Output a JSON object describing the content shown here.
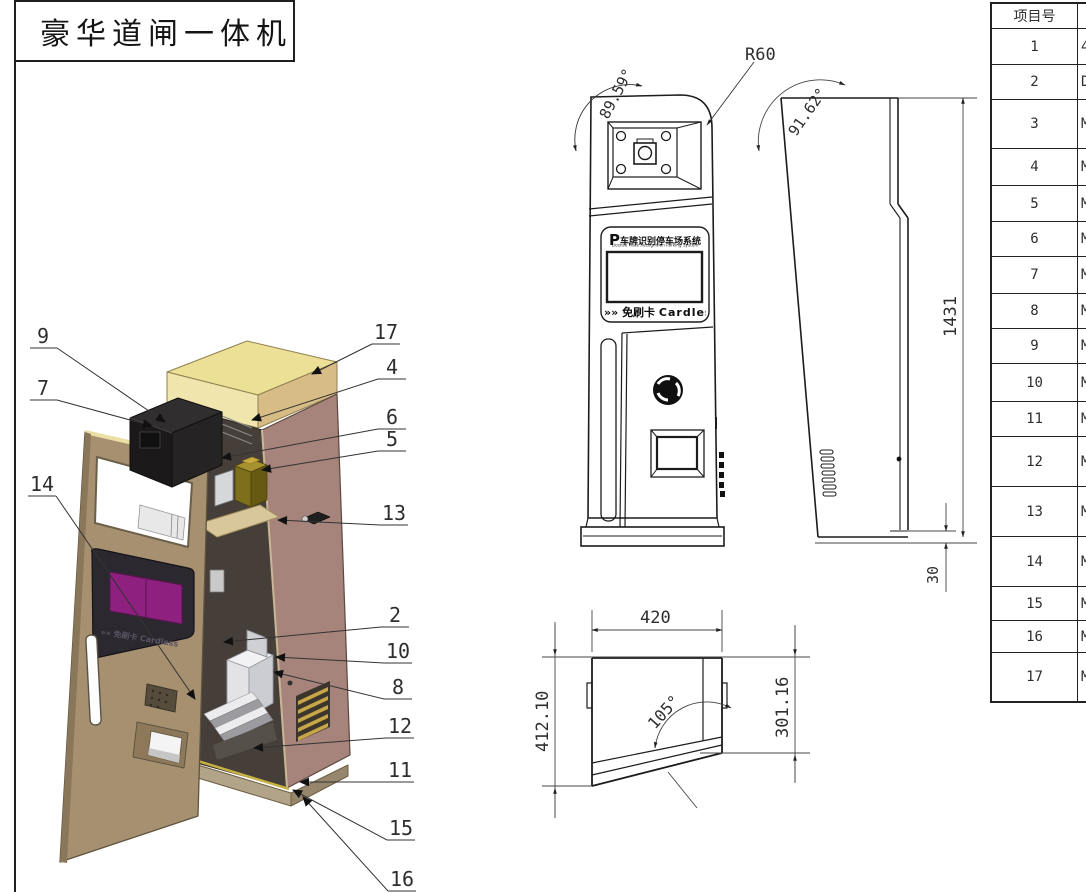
{
  "title_block": {
    "title": "豪华道闸一体机"
  },
  "sign": {
    "brand_p": "P",
    "brand_cn": "车牌识别停车场系统",
    "brand_en": "License Plate Recognition Parking System",
    "tag_arrows": "»",
    "tag_cn": "免刷卡",
    "tag_en": "Cardless"
  },
  "front_dims": {
    "corner_radius": "R60",
    "top_angle": "89.59°"
  },
  "side_dims": {
    "height": "1431",
    "angle": "91.62°",
    "base_height": "30"
  },
  "top_dims": {
    "width": "420",
    "left_depth": "412.10",
    "right_depth": "301.16",
    "angle": "105°"
  },
  "callouts": {
    "left": [
      "9",
      "7",
      "14"
    ],
    "right": [
      "17",
      "4",
      "6",
      "5",
      "13",
      "2",
      "10",
      "8",
      "12",
      "11",
      "15",
      "16"
    ]
  },
  "bom_table": {
    "header_col1": "项目号",
    "rows": [
      {
        "no": "1",
        "part": "4"
      },
      {
        "no": "2",
        "part": "D"
      },
      {
        "no": "3",
        "part": "M"
      },
      {
        "no": "4",
        "part": "M"
      },
      {
        "no": "5",
        "part": "M"
      },
      {
        "no": "6",
        "part": "M"
      },
      {
        "no": "7",
        "part": "M"
      },
      {
        "no": "8",
        "part": "M"
      },
      {
        "no": "9",
        "part": "M"
      },
      {
        "no": "10",
        "part": "M"
      },
      {
        "no": "11",
        "part": "M"
      },
      {
        "no": "12",
        "part": "M"
      },
      {
        "no": "13",
        "part": "M"
      },
      {
        "no": "14",
        "part": "M"
      },
      {
        "no": "15",
        "part": "M"
      },
      {
        "no": "16",
        "part": "M"
      },
      {
        "no": "17",
        "part": "M"
      }
    ]
  },
  "colors": {
    "cabinet_body": "#a6837b",
    "cabinet_top": "#ebe096",
    "door": "#a69070",
    "screen": "#8e2080",
    "component_box": "#7e6f1c",
    "line": "#1c1c1c"
  }
}
